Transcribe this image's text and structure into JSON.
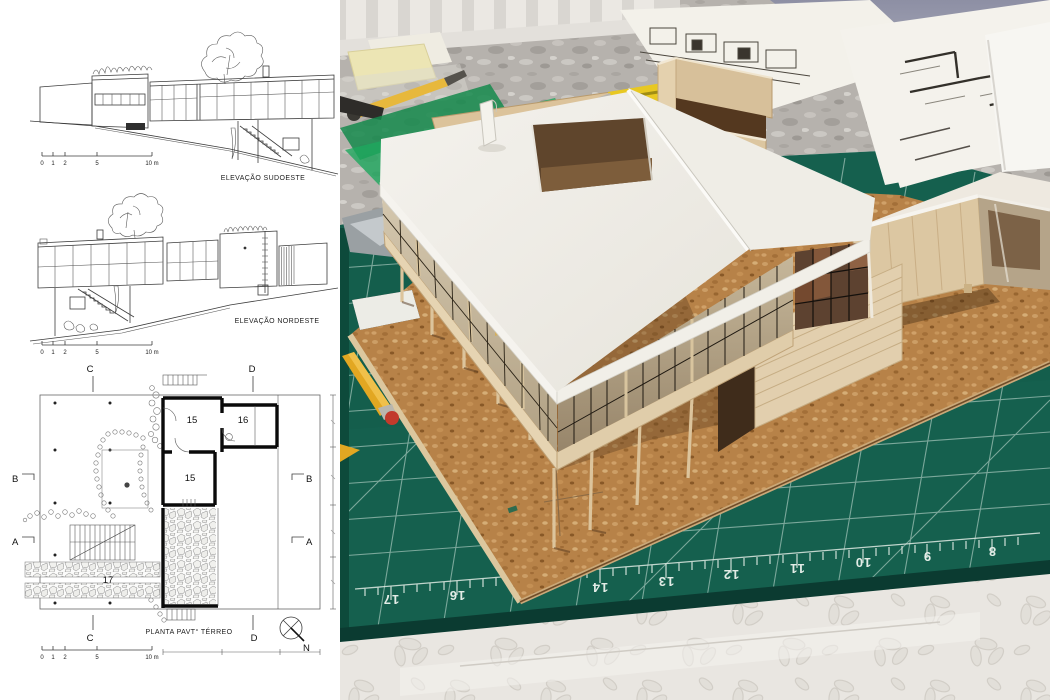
{
  "left_panel": {
    "elevation_sw": {
      "caption": "ELEVAÇÃO SUDOESTE"
    },
    "elevation_ne": {
      "caption": "ELEVAÇÃO NORDESTE"
    },
    "plan": {
      "caption": "PLANTA PAVT° TÉRREO",
      "north_label": "N",
      "rooms": {
        "r15a": "15",
        "r15b": "15",
        "r16": "16",
        "r17": "17"
      },
      "sections": {
        "a": "A",
        "b": "B",
        "c": "C",
        "d": "D"
      }
    },
    "scale_ticks": [
      "0",
      "1",
      "2",
      "5",
      "10 m"
    ]
  },
  "photo": {
    "cutting_mat": {
      "numbers": [
        "17",
        "16",
        "14",
        "13",
        "12",
        "11",
        "10",
        "9",
        "8"
      ],
      "color": "#15604E"
    },
    "materials": {
      "cork": "#C08A4E",
      "balsa": "#DFC9A4",
      "card_white": "#F1EFE9",
      "table_marble": "#B6B2AD",
      "wall": "#979AAD",
      "tablecloth": "#E9E6E1",
      "pencil_yellow": "#E2A722",
      "pencil_tip_red": "#C23A2B",
      "set_square_green": "#1E9E5C",
      "utility_knife_yellow": "#E8C822"
    }
  }
}
